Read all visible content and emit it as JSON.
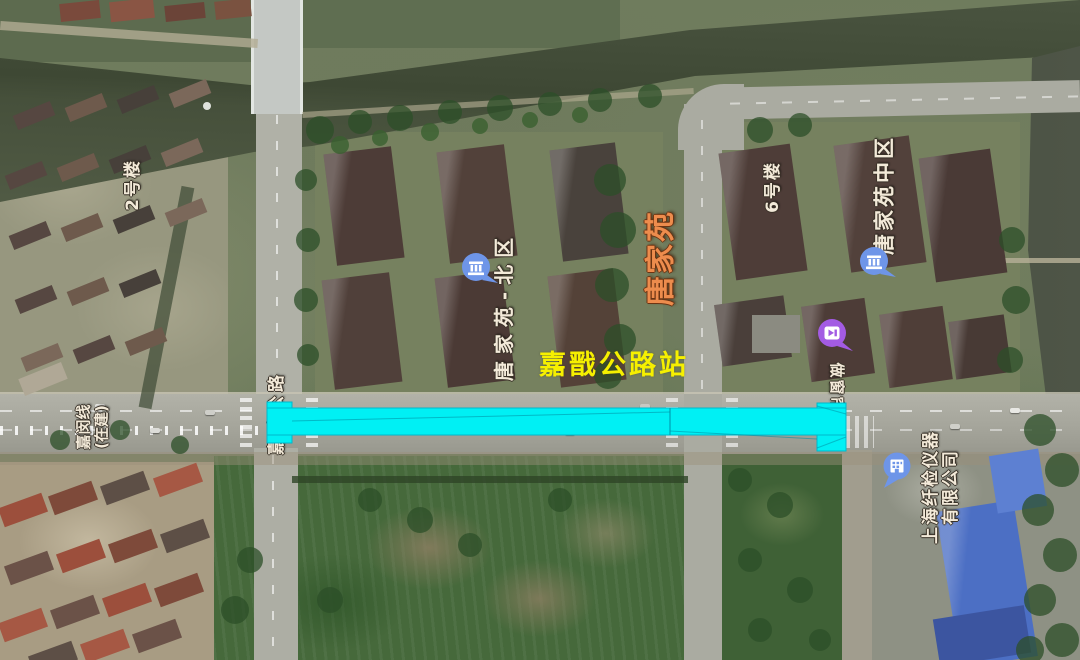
{
  "map": {
    "type": "satellite-map-screenshot",
    "labels": {
      "station": "嘉戬公路站",
      "metro_line": {
        "line1": "嘉闵线",
        "line2": "(在建)"
      },
      "area": "唐家苑",
      "subdistrict_north": "唐家苑-北区",
      "subdistrict_central": "唐家苑中区",
      "building_2": "2号楼",
      "building_6": "6号楼",
      "road": "嘉戬公路",
      "shop": "做窗帘",
      "company": {
        "line1": "上海纤检仪器",
        "line2": "有限公司"
      }
    },
    "pois": [
      {
        "name": "唐家苑-北区",
        "icon": "community-icon",
        "color": "#6e95e8"
      },
      {
        "name": "唐家苑中区",
        "icon": "community-icon",
        "color": "#6e95e8"
      },
      {
        "name": "做窗帘",
        "icon": "shop-icon",
        "color": "#a35be3"
      },
      {
        "name": "上海纤检仪器有限公司",
        "icon": "company-icon",
        "color": "#6e95e8"
      }
    ],
    "colors": {
      "station_overlay": "#00f0f4",
      "station_overlay_stroke": "#00b8cc",
      "station_label": "#f6f000",
      "area_label": "#ed8c4d",
      "poi_label": "#f3ead9",
      "community_pin": "#6e95e8",
      "shop_pin": "#a35be3",
      "water": "#47513c",
      "road": "#a8a89e",
      "field": "#46693b",
      "roof_dark": "#4a3b36",
      "roof_blue": "#4c6fc4"
    }
  }
}
